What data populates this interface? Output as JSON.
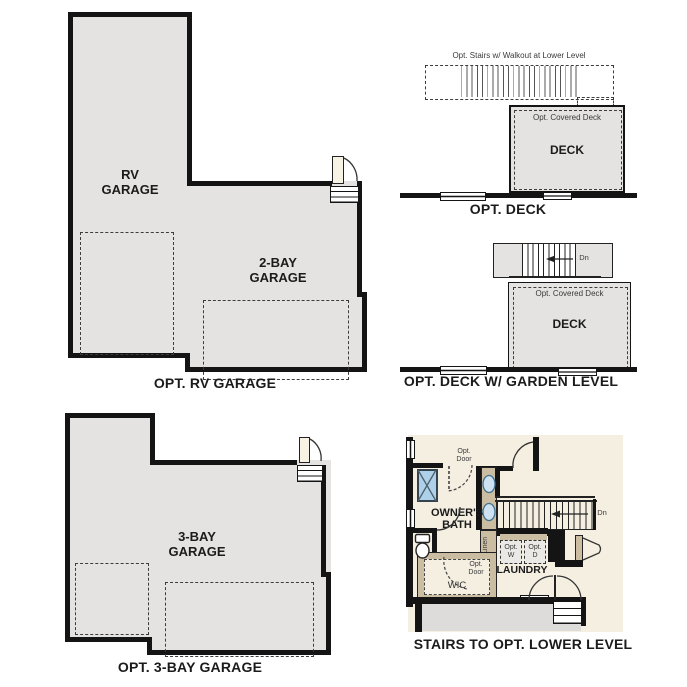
{
  "colors": {
    "wall": "#141414",
    "garage_fill": "#e4e3e1",
    "plan_background": "#f5efe2",
    "cabinet_tan": "#cbbda2",
    "shower_blue": "#aed0e8",
    "sink_blue": "#cde1f0",
    "door_cream": "#f8f2e5",
    "lower_garage_fill": "#dddcda"
  },
  "plans": {
    "rv_garage": {
      "caption": "OPT. RV GARAGE",
      "rv_label": "RV GARAGE",
      "two_bay_label": "2-BAY GARAGE"
    },
    "opt_deck": {
      "caption": "OPT. DECK",
      "stairs_note": "Opt. Stairs w/ Walkout at Lower Level",
      "covered_label": "Opt. Covered Deck",
      "deck_label": "DECK"
    },
    "garden_deck": {
      "caption": "OPT. DECK W/ GARDEN LEVEL",
      "covered_label": "Opt. Covered Deck",
      "deck_label": "DECK",
      "down_label": "Dn"
    },
    "three_bay": {
      "caption": "OPT. 3-BAY GARAGE",
      "room_label": "3-BAY GARAGE"
    },
    "lower_level": {
      "caption": "STAIRS TO OPT. LOWER LEVEL",
      "owners_bath": "OWNER'S BATH",
      "opt_door_top": "Opt. Door",
      "opt_door_wic": "Opt. Door",
      "wic": "WIC",
      "linen": "Linen",
      "laundry": "LAUNDRY",
      "opt_w": "Opt. W",
      "opt_d": "Opt. D",
      "down_label": "Dn"
    }
  }
}
